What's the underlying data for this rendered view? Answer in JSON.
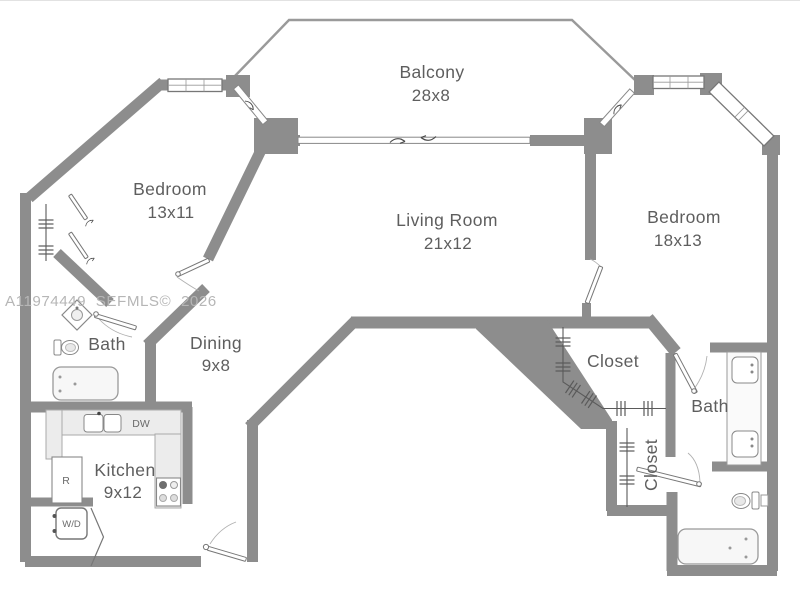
{
  "watermark": "A11974449 SEFMLS© 2026",
  "rooms": {
    "balcony": {
      "name": "Balcony",
      "dims": "28x8"
    },
    "bedroom_left": {
      "name": "Bedroom",
      "dims": "13x11"
    },
    "living_room": {
      "name": "Living Room",
      "dims": "21x12"
    },
    "bedroom_right": {
      "name": "Bedroom",
      "dims": "18x13"
    },
    "dining": {
      "name": "Dining",
      "dims": "9x8"
    },
    "kitchen": {
      "name": "Kitchen",
      "dims": "9x12"
    },
    "bath_left": {
      "name": "Bath"
    },
    "bath_right": {
      "name": "Bath"
    },
    "closet_walkin": {
      "name": "Closet"
    },
    "closet_hall": {
      "name": "Closet"
    }
  },
  "appliance_labels": {
    "dishwasher": "DW",
    "refrigerator": "R",
    "washer_dryer": "W/D"
  },
  "colors": {
    "wall": "#8d8d8d",
    "thin_line": "#8a8a8a",
    "label_text": "#5e5e5e",
    "watermark": "#b6b6b6",
    "fixture_fill": "#f7f7f7",
    "counter_fill": "#ececec",
    "background": "#ffffff"
  }
}
